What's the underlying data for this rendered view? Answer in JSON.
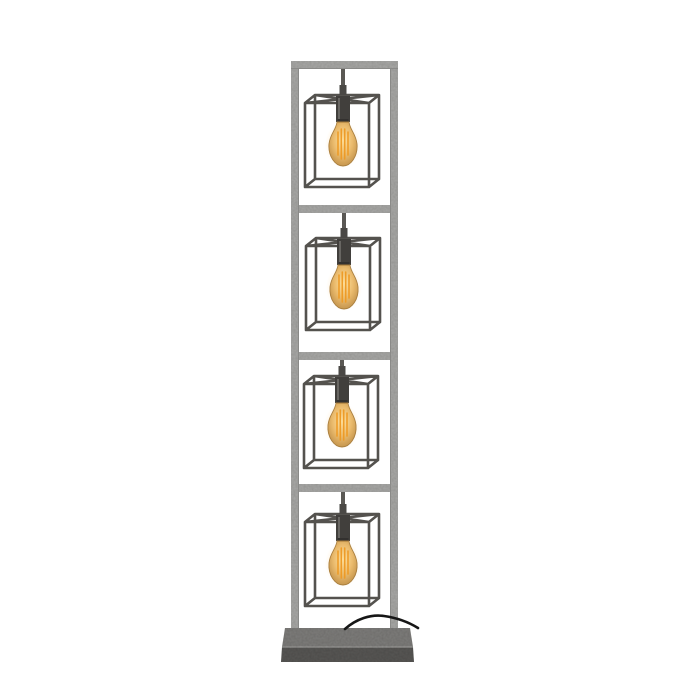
{
  "image": {
    "type": "product-photo",
    "alt": "Industrial floor lamp: tall old-silver metal frame divided into four sections, each holding a suspended open cube cage with a lit amber Edison filament bulb, standing on a rectangular mottled grey metal base with a black power cord draped over it",
    "lamp": {
      "bulb_count": 4,
      "cage_shape": "open wireframe cube",
      "bulb_style": "amber Edison filament, 4 vertical filaments",
      "sections": [
        {
          "x": 305,
          "y": 95,
          "rod_top": 65
        },
        {
          "x": 306,
          "y": 238,
          "rod_top": 209
        },
        {
          "x": 304,
          "y": 376,
          "rod_top": 356
        },
        {
          "x": 305,
          "y": 514,
          "rod_top": 488
        }
      ]
    },
    "colors": {
      "background": "#ffffff",
      "frame": "#a9a9a7",
      "frame_edge": "#868684",
      "cage": "#54524e",
      "rod": "#5a5854",
      "knuckle": "#4a4845",
      "socket": "#413f3c",
      "socket_rim": "#33312f",
      "socket_highlight": "#7b7975",
      "bulb_glass_center": "#ffe3a1",
      "bulb_glass_mid": "#eab969",
      "bulb_glass_edge": "#bf8e45",
      "bulb_outline": "#a87c3a",
      "filament": "#ee9a24",
      "glow": "#ffc568",
      "cable": "#161616",
      "base_top": "#7e7d7b",
      "base_front": "#585755",
      "base_edge": "#999896"
    }
  }
}
